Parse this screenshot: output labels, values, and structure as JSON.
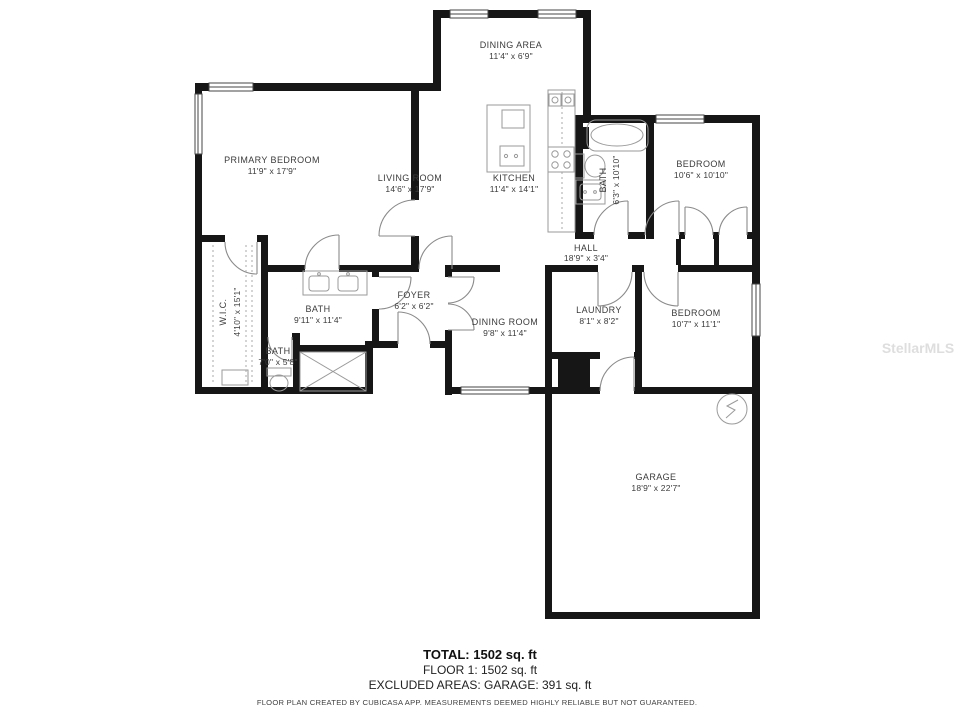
{
  "watermark": "StellarMLS",
  "rooms": {
    "dining_area": {
      "name": "DINING AREA",
      "dims": "11'4\" x 6'9\""
    },
    "primary_bedroom": {
      "name": "PRIMARY BEDROOM",
      "dims": "11'9\" x 17'9\""
    },
    "living_room": {
      "name": "LIVING ROOM",
      "dims": "14'6\" x 17'9\""
    },
    "kitchen": {
      "name": "KITCHEN",
      "dims": "11'4\" x 14'1\""
    },
    "bath1": {
      "name": "BATH",
      "dims": "6'3\" x 10'10\""
    },
    "bedroom1": {
      "name": "BEDROOM",
      "dims": "10'6\" x 10'10\""
    },
    "hall": {
      "name": "HALL",
      "dims": "18'9\" x 3'4\""
    },
    "wic": {
      "name": "W.I.C.",
      "dims": "4'10\" x 15'1\""
    },
    "bath2": {
      "name": "BATH",
      "dims": "9'11\" x 11'4\""
    },
    "bath3": {
      "name": "BATH",
      "dims": "7'0\" x 5'8\""
    },
    "foyer": {
      "name": "FOYER",
      "dims": "6'2\" x 6'2\""
    },
    "dining_room": {
      "name": "DINING ROOM",
      "dims": "9'8\" x 11'4\""
    },
    "laundry": {
      "name": "LAUNDRY",
      "dims": "8'1\" x 8'2\""
    },
    "bedroom2": {
      "name": "BEDROOM",
      "dims": "10'7\" x 11'1\""
    },
    "garage": {
      "name": "GARAGE",
      "dims": "18'9\" x 22'7\""
    }
  },
  "summary": {
    "total": "TOTAL: 1502 sq. ft",
    "floor": "FLOOR 1: 1502 sq. ft",
    "excluded": "EXCLUDED AREAS: GARAGE: 391 sq. ft"
  },
  "disclaimer": "FLOOR PLAN CREATED BY CUBICASA APP. MEASUREMENTS DEEMED HIGHLY RELIABLE BUT NOT GUARANTEED.",
  "colors": {
    "wall": "#161616",
    "fixture": "#9a9a9a",
    "label": "#3b3b3b",
    "watermark": "#dedede"
  }
}
